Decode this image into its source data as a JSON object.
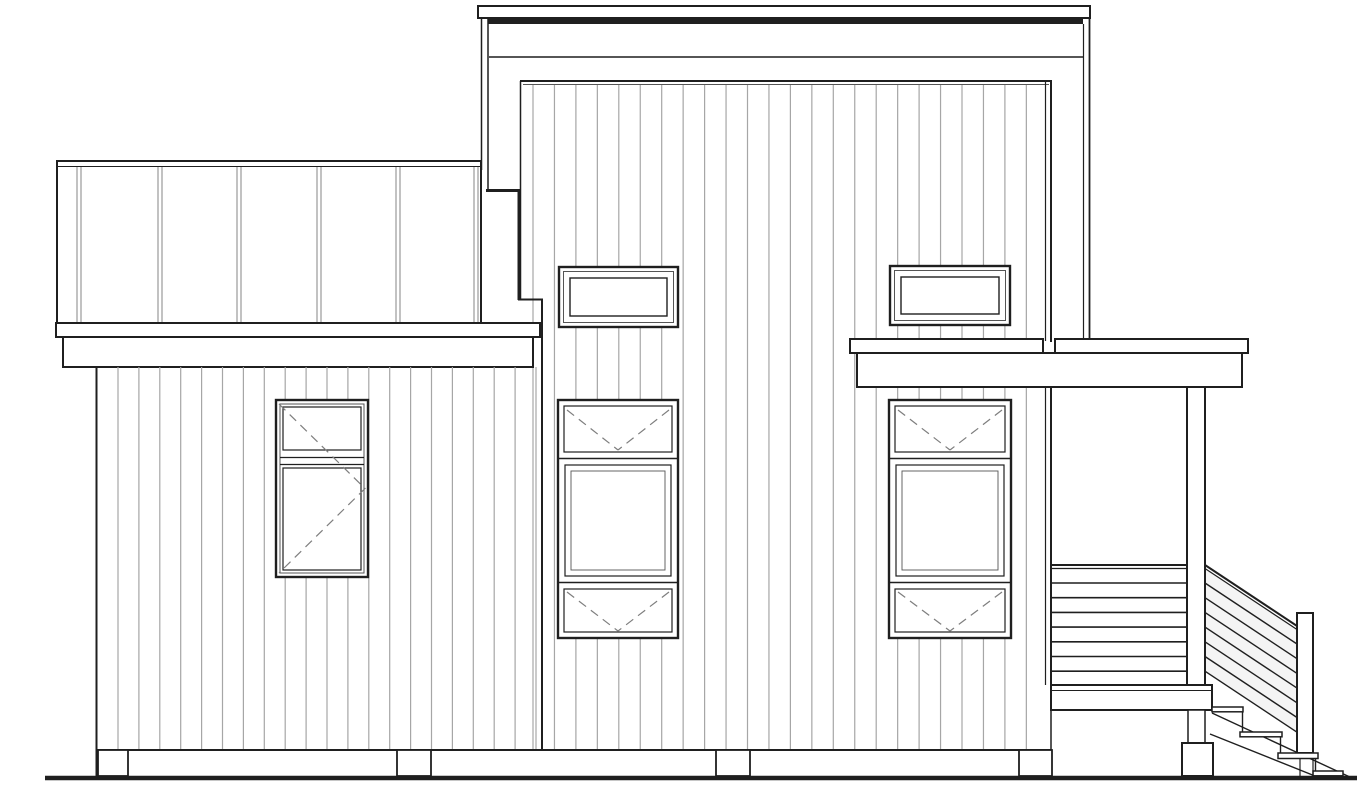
{
  "drawing": {
    "title": "house-rear-elevation-line-drawing",
    "background": "#ffffff",
    "line_color": "#1f1f1f",
    "siding_color": "#a6a6a6",
    "batten_color": "#9a9a9a",
    "dash_color": "#7e7e7e",
    "tint_color": "#ebebeb"
  },
  "canvas": {
    "width": 1357,
    "height": 800
  },
  "ground": {
    "x1": 45,
    "x2": 1357,
    "y": 778,
    "thickness": 4.5
  },
  "left_wing": {
    "siding": {
      "start": 118,
      "spacing": 20.9,
      "count": 21,
      "y1": 367,
      "y2": 750
    },
    "battens": {
      "xs": [
        77,
        158,
        237,
        317,
        396,
        474
      ],
      "gap": 4,
      "y1": 167,
      "y2": 322
    }
  },
  "tower": {
    "siding": {
      "start": 533,
      "spacing": 21.45,
      "count": 24,
      "y1": 85,
      "y2": 750
    }
  },
  "foundation": {
    "piers": [
      {
        "x": 98,
        "w": 30
      },
      {
        "x": 397,
        "w": 34
      },
      {
        "x": 716,
        "w": 34
      },
      {
        "x": 1019,
        "w": 33
      }
    ],
    "y1": 750,
    "y2": 776
  },
  "porch": {
    "guard_rails": {
      "x1": 1052,
      "x2": 1187,
      "top_y": 565,
      "first_offset": 18,
      "spacing": 14.7,
      "count": 7
    },
    "stair_rails": {
      "x1": 1205,
      "x2": 1297,
      "top_y": 565,
      "drop": 61,
      "first_offset": 18,
      "spacing": 14.7,
      "count": 7
    },
    "tint": [
      [
        1205,
        568
      ],
      [
        1297,
        629
      ],
      [
        1297,
        733
      ],
      [
        1205,
        672
      ]
    ]
  },
  "stairs": {
    "treads": [
      {
        "x": 1212,
        "y": 707,
        "w": 31
      },
      {
        "x": 1240,
        "y": 732,
        "w": 42
      },
      {
        "x": 1313,
        "y": 771,
        "w": 30
      }
    ],
    "risers": [
      [
        1242.5,
        711,
        732
      ],
      [
        1280.5,
        736,
        753
      ],
      [
        1315.5,
        758,
        771
      ]
    ],
    "stringers": [
      [
        1212,
        713,
        1352,
        778
      ],
      [
        1210,
        734,
        1320,
        778
      ]
    ]
  },
  "windows": [
    {
      "id": "left-casement-window",
      "type": "casement",
      "x": 276,
      "y": 400,
      "w": 92,
      "h": 177,
      "midrail": 457
    },
    {
      "id": "center-clerestory-window",
      "type": "fixed",
      "x": 559,
      "y": 267,
      "w": 119,
      "h": 60
    },
    {
      "id": "right-clerestory-window",
      "type": "fixed",
      "x": 890,
      "y": 266,
      "w": 120,
      "h": 59
    },
    {
      "id": "center-awning-stack",
      "type": "awning-stack",
      "x": 558,
      "y": 400,
      "w": 120,
      "h": 238,
      "top_h": 58,
      "bottom_h": 55
    },
    {
      "id": "right-awning-stack",
      "type": "awning-stack",
      "x": 889,
      "y": 400,
      "w": 122,
      "h": 238,
      "top_h": 58,
      "bottom_h": 55
    }
  ]
}
